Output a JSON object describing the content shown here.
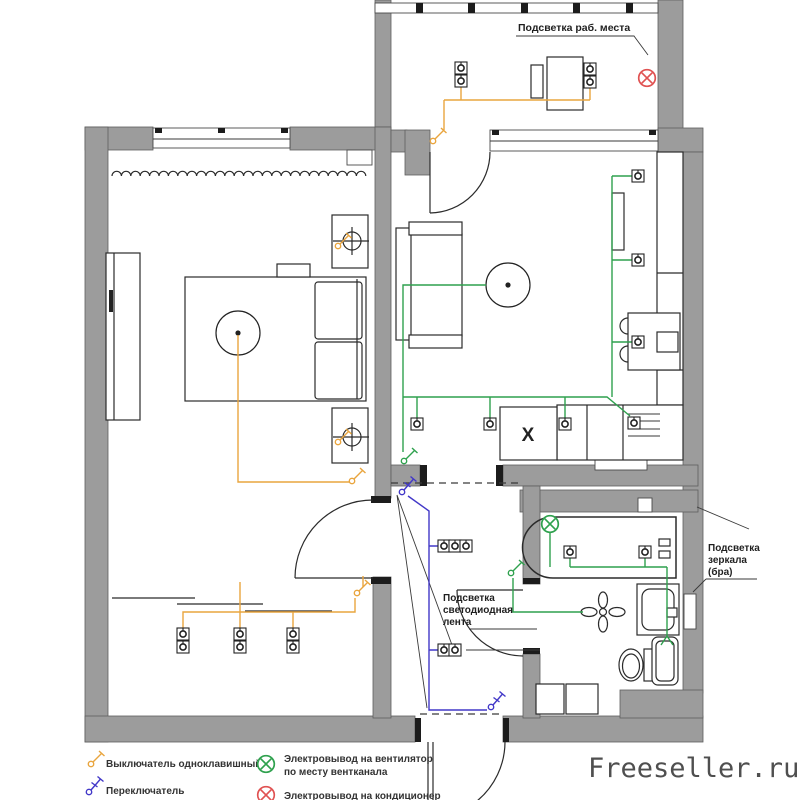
{
  "plan_labels": {
    "workplace": "Подсветка раб. места",
    "mirror_line1": "Подсветка",
    "mirror_line2": "зеркала",
    "mirror_line3": "(бра)",
    "led_line1": "Подсветка",
    "led_line2": "светодиодная",
    "led_line3": "лента",
    "stove": "X"
  },
  "legend": {
    "items": [
      {
        "icon": "single-switch-icon",
        "label": "Выключатель одноклавишный"
      },
      {
        "icon": "two-way-switch-icon",
        "label": "Переключатель"
      },
      {
        "icon": "fan-outlet-icon",
        "label_line1": "Электровывод на вентилятор",
        "label_line2": "по месту вентканала"
      },
      {
        "icon": "ac-outlet-icon",
        "label": "Электровывод на кондиционер"
      }
    ]
  },
  "watermark": "Freeseller.ru",
  "colors": {
    "wall": "#9c9c9c",
    "wire_lighting": "#e9a53e",
    "wire_power": "#2fa14e",
    "wire_switch2": "#4238c8",
    "ac_outlet": "#e05252",
    "fan_outlet": "#2fa14e",
    "ink": "#2b2b2b",
    "watermark": "#4f4f4f"
  }
}
